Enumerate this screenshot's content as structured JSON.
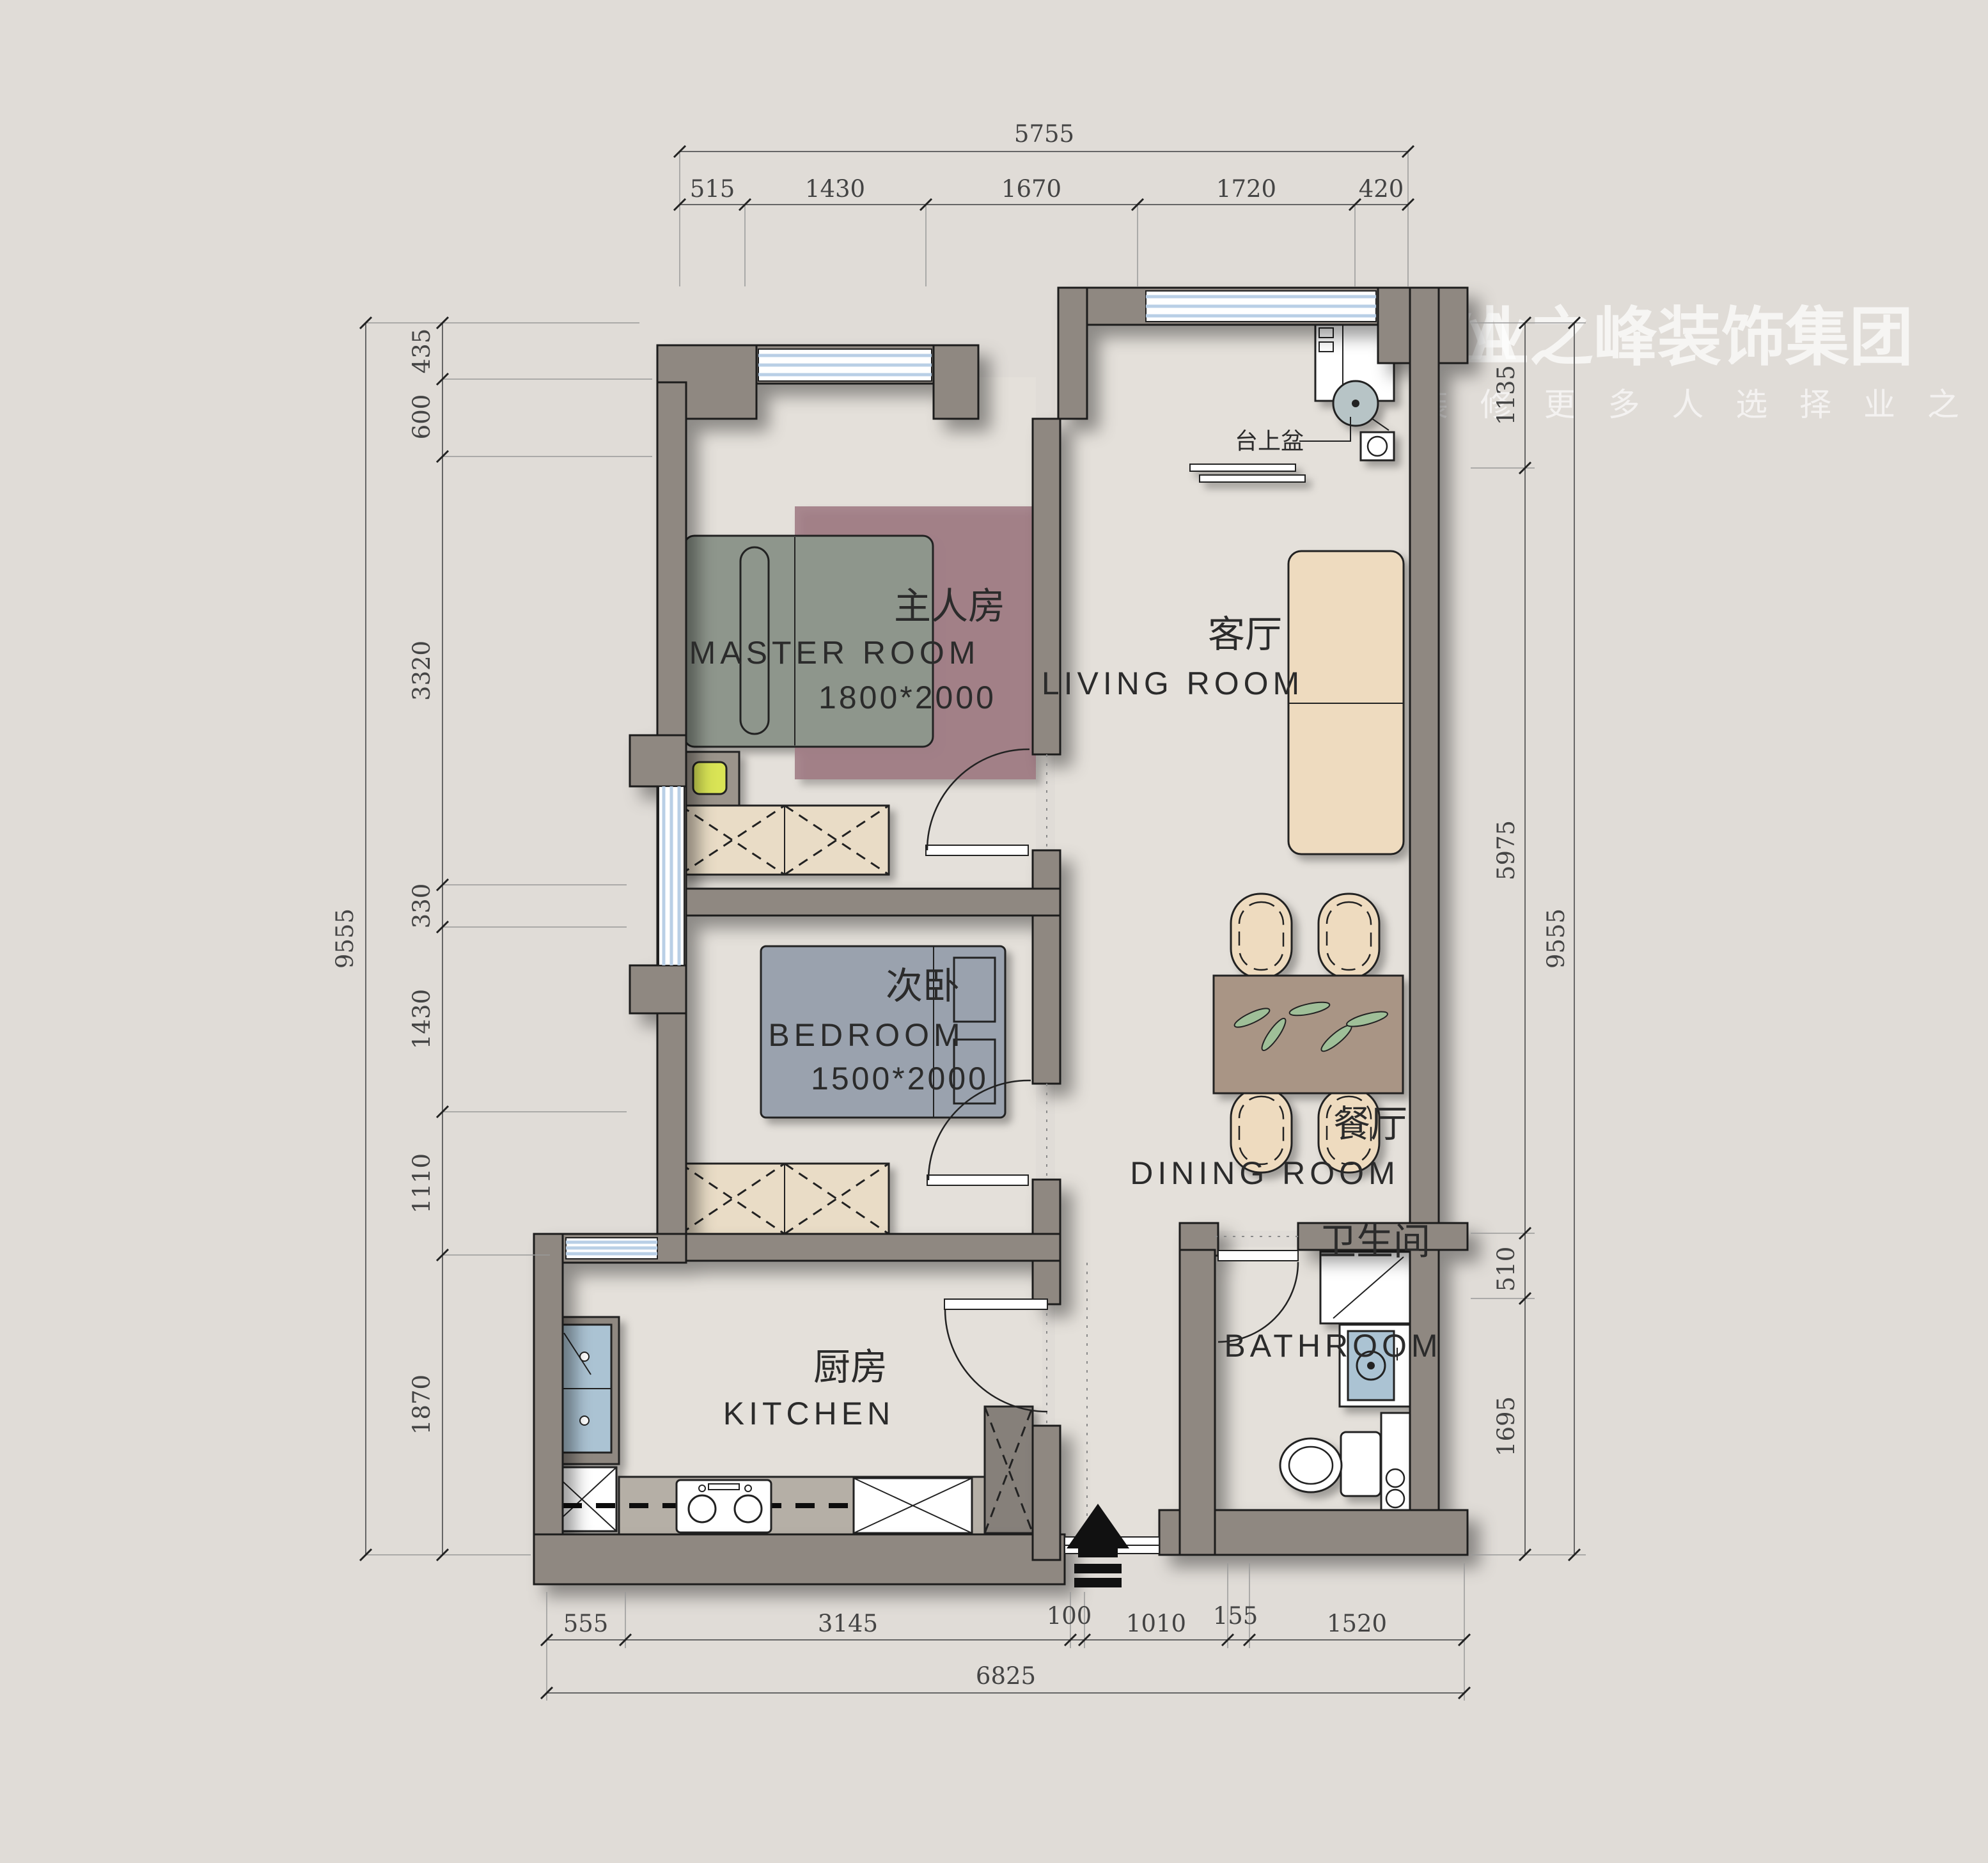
{
  "logo": {
    "brand": "YENOVA",
    "company": "业之峰装饰集团",
    "tagline": "家 庭 装 修  更 多 人 选 择 业 之 峰"
  },
  "rooms": {
    "master": {
      "zh": "主人房",
      "en": "MASTER ROOM",
      "size": "1800*2000"
    },
    "bedroom": {
      "zh": "次卧",
      "en": "BEDROOM",
      "size": "1500*2000"
    },
    "living": {
      "zh": "客厅",
      "en": "LIVING ROOM"
    },
    "dining": {
      "zh": "餐厅",
      "en": "DINING ROOM"
    },
    "kitchen": {
      "zh": "厨房",
      "en": "KITCHEN"
    },
    "bathroom": {
      "zh": "卫生间",
      "en": "BATHROOM"
    }
  },
  "annotations": {
    "basin": "台上盆"
  },
  "dimensions": {
    "top": {
      "overall": "5755",
      "segments": [
        "515",
        "1430",
        "1670",
        "1720",
        "420"
      ]
    },
    "left": {
      "overall": "9555",
      "segments": [
        "435",
        "600",
        "3320",
        "330",
        "1430",
        "1110",
        "1870"
      ]
    },
    "right": {
      "overall": "9555",
      "segments": [
        "1135",
        "5975",
        "510",
        "1695"
      ]
    },
    "bottom": {
      "overall": "6825",
      "segments": [
        "555",
        "3145",
        "100",
        "1010",
        "155",
        "1520"
      ]
    }
  },
  "colors": {
    "background": "#e0dcd7",
    "wall": "#8f8881",
    "window": "#b9cfe6",
    "master_bed": "#8e968c",
    "rug": "#9b737e",
    "second_bed": "#9aa2ae",
    "wardrobe": "#e9dcc6",
    "dining_table": "#a99585",
    "chair": "#eedbbf",
    "leaf": "#9fbf98",
    "sink": "#abc3d3",
    "basin": "#b7c4c6",
    "lamp": "#d9e455",
    "counter": "#b5afa6",
    "logo": "#ffffff"
  }
}
